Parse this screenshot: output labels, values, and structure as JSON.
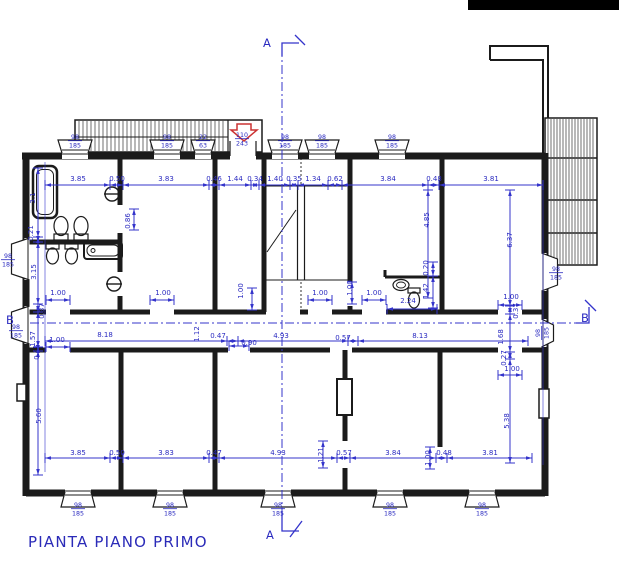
{
  "title": "PIANTA PIANO PRIMO",
  "colors": {
    "dim_blue": "#3434cb",
    "text_blue": "#2a2ac0",
    "wall_black": "#1b1b1b",
    "arrow_red": "#cc3333"
  },
  "section_markers": [
    {
      "t": "A",
      "x": 263,
      "y": 47
    },
    {
      "t": "A",
      "x": 266,
      "y": 539
    },
    {
      "t": "B",
      "x": 6,
      "y": 324
    },
    {
      "t": "B",
      "x": 581,
      "y": 322
    }
  ],
  "dim_labels": [
    {
      "x": 78,
      "y": 181,
      "t": "3.85"
    },
    {
      "x": 117,
      "y": 181,
      "t": "0.50"
    },
    {
      "x": 166,
      "y": 181,
      "t": "3.83"
    },
    {
      "x": 214,
      "y": 181,
      "t": "0.46"
    },
    {
      "x": 235,
      "y": 181,
      "t": "1.44"
    },
    {
      "x": 255,
      "y": 181,
      "t": "0.34"
    },
    {
      "x": 275,
      "y": 181,
      "t": "1.40"
    },
    {
      "x": 294,
      "y": 181,
      "t": "0.35"
    },
    {
      "x": 313,
      "y": 181,
      "t": "1.34"
    },
    {
      "x": 335,
      "y": 181,
      "t": "0.62"
    },
    {
      "x": 388,
      "y": 181,
      "t": "3.84"
    },
    {
      "x": 434,
      "y": 181,
      "t": "0.48"
    },
    {
      "x": 491,
      "y": 181,
      "t": "3.81"
    },
    {
      "x": 78,
      "y": 455,
      "t": "3.85"
    },
    {
      "x": 117,
      "y": 455,
      "t": "0.50"
    },
    {
      "x": 166,
      "y": 455,
      "t": "3.83"
    },
    {
      "x": 214,
      "y": 455,
      "t": "0.47"
    },
    {
      "x": 278,
      "y": 455,
      "t": "4.93"
    },
    {
      "x": 323,
      "y": 455,
      "t": "1.21",
      "r": 1
    },
    {
      "x": 344,
      "y": 455,
      "t": "0.57"
    },
    {
      "x": 393,
      "y": 455,
      "t": "3.84"
    },
    {
      "x": 430,
      "y": 458,
      "t": "1.00",
      "r": 1
    },
    {
      "x": 444,
      "y": 455,
      "t": "0.48"
    },
    {
      "x": 490,
      "y": 455,
      "t": "3.81"
    },
    {
      "x": 105,
      "y": 337,
      "t": "8.18"
    },
    {
      "x": 199,
      "y": 334,
      "t": "1.12",
      "r": 1
    },
    {
      "x": 218,
      "y": 338,
      "t": "0.47"
    },
    {
      "x": 249,
      "y": 345,
      "t": "0.90"
    },
    {
      "x": 281,
      "y": 338,
      "t": "4.93"
    },
    {
      "x": 343,
      "y": 340,
      "t": "0.57"
    },
    {
      "x": 420,
      "y": 338,
      "t": "8.13"
    },
    {
      "x": 503,
      "y": 337,
      "t": "1.68",
      "r": 1
    },
    {
      "x": 58,
      "y": 295,
      "t": "1.00"
    },
    {
      "x": 163,
      "y": 295,
      "t": "1.00"
    },
    {
      "x": 243,
      "y": 291,
      "t": "1.00",
      "r": 1
    },
    {
      "x": 320,
      "y": 295,
      "t": "1.00"
    },
    {
      "x": 352,
      "y": 288,
      "t": "1.00",
      "r": 1
    },
    {
      "x": 374,
      "y": 295,
      "t": "1.00"
    },
    {
      "x": 511,
      "y": 299,
      "t": "1.00"
    },
    {
      "x": 57,
      "y": 342,
      "t": "1.00"
    },
    {
      "x": 512,
      "y": 371,
      "t": "1.00"
    },
    {
      "x": 408,
      "y": 303,
      "t": "2.24"
    },
    {
      "x": 428,
      "y": 291,
      "t": "1.42",
      "r": 1
    },
    {
      "x": 428,
      "y": 268,
      "t": "0.20",
      "r": 1
    },
    {
      "x": 130,
      "y": 221,
      "t": "0.86",
      "r": 1
    },
    {
      "x": 35,
      "y": 198,
      "t": "3.1",
      "r": 1
    },
    {
      "x": 33,
      "y": 233,
      "t": "0.21",
      "r": 1
    },
    {
      "x": 36,
      "y": 272,
      "t": "3.15",
      "r": 1
    },
    {
      "x": 44,
      "y": 311,
      "t": "0.37",
      "r": 1
    },
    {
      "x": 35,
      "y": 339,
      "t": "1.57",
      "r": 1
    },
    {
      "x": 39,
      "y": 352,
      "t": "0.15",
      "r": 1
    },
    {
      "x": 41,
      "y": 416,
      "t": "5.60",
      "r": 1
    },
    {
      "x": 429,
      "y": 220,
      "t": "4.85",
      "r": 1
    },
    {
      "x": 512,
      "y": 240,
      "t": "6.37",
      "r": 1
    },
    {
      "x": 509,
      "y": 421,
      "t": "5.38",
      "r": 1
    },
    {
      "x": 518,
      "y": 311,
      "t": "0.37",
      "r": 1
    },
    {
      "x": 506,
      "y": 358,
      "t": "0.27",
      "r": 1
    }
  ],
  "window_labels": [
    {
      "x": 75,
      "y": 139,
      "a": "98",
      "b": "185"
    },
    {
      "x": 167,
      "y": 139,
      "a": "98",
      "b": "185"
    },
    {
      "x": 203,
      "y": 139,
      "a": "22",
      "b": "63"
    },
    {
      "x": 242,
      "y": 137,
      "a": "110",
      "b": "243"
    },
    {
      "x": 285,
      "y": 139,
      "a": "98",
      "b": "185"
    },
    {
      "x": 322,
      "y": 139,
      "a": "98",
      "b": "185"
    },
    {
      "x": 392,
      "y": 139,
      "a": "98",
      "b": "185"
    },
    {
      "x": 78,
      "y": 507,
      "a": "98",
      "b": "185"
    },
    {
      "x": 170,
      "y": 507,
      "a": "98",
      "b": "185"
    },
    {
      "x": 278,
      "y": 507,
      "a": "98",
      "b": "185"
    },
    {
      "x": 390,
      "y": 507,
      "a": "98",
      "b": "185"
    },
    {
      "x": 482,
      "y": 507,
      "a": "98",
      "b": "185"
    },
    {
      "x": 8,
      "y": 258,
      "a": "98",
      "b": "185"
    },
    {
      "x": 16,
      "y": 329,
      "a": "98",
      "b": "185"
    },
    {
      "x": 556,
      "y": 271,
      "a": "98",
      "b": "185"
    },
    {
      "x": 540,
      "y": 333,
      "a": "98",
      "b": "185",
      "r": 1
    }
  ]
}
